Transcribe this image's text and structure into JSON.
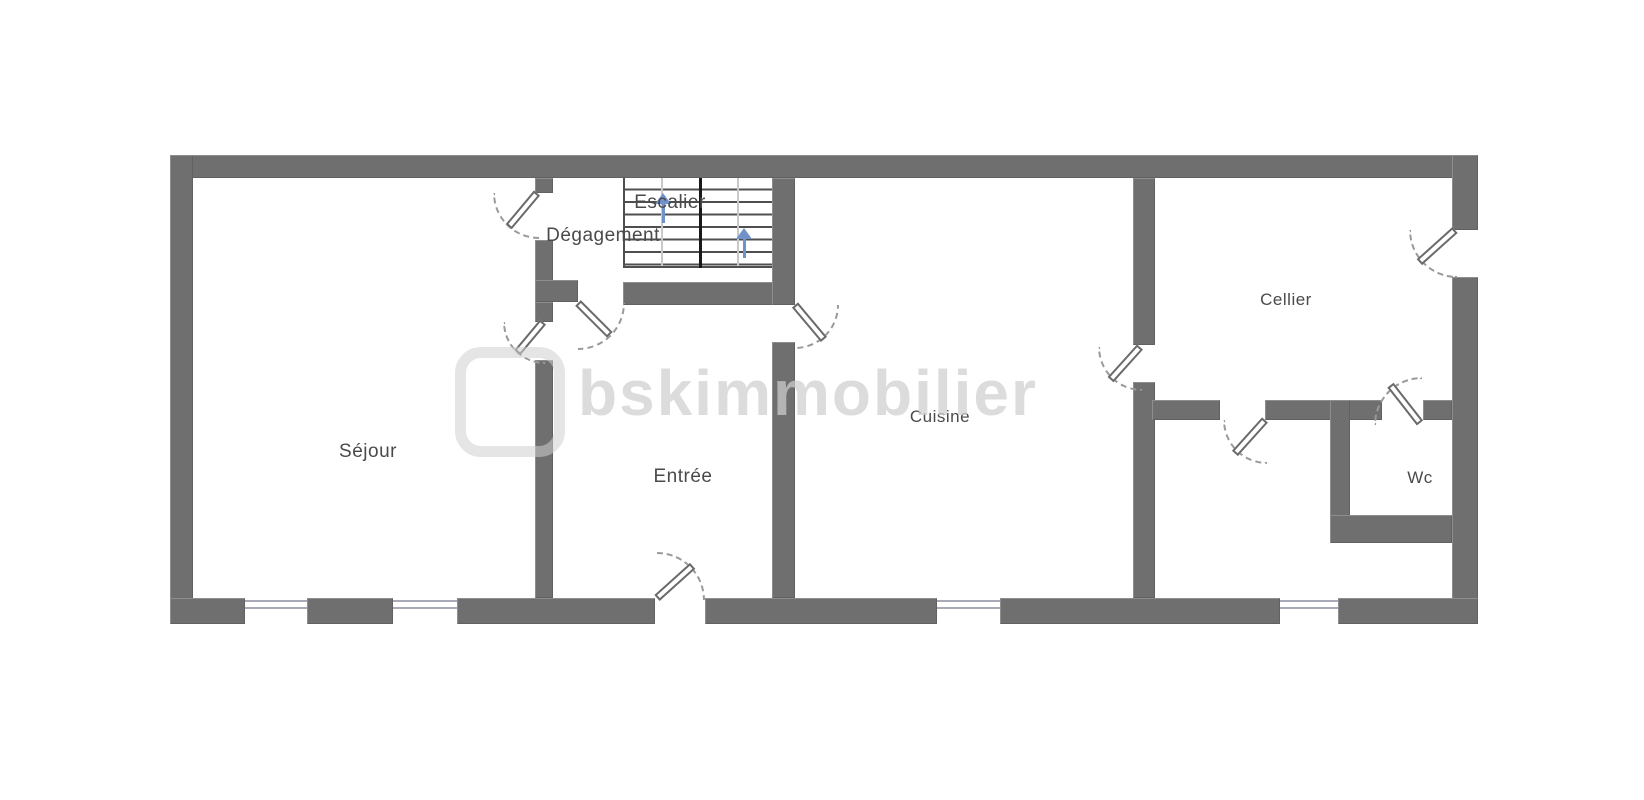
{
  "plan": {
    "rooms": [
      {
        "id": "sejour",
        "label": "Séjour"
      },
      {
        "id": "degagement",
        "label": "Dégagement"
      },
      {
        "id": "escalier",
        "label": "Escalier"
      },
      {
        "id": "entree",
        "label": "Entrée"
      },
      {
        "id": "cuisine",
        "label": "Cuisine"
      },
      {
        "id": "cellier",
        "label": "Cellier"
      },
      {
        "id": "wc",
        "label": "Wc"
      }
    ],
    "colors": {
      "wall": "#6f6f6f",
      "label": "#4a4a4a",
      "stair_arrow": "#7191c9",
      "window_line": "#a9aab8",
      "door_line": "#6a6a6a",
      "arc_line": "#9a9a9a",
      "stair_line": "#4f4f4f",
      "watermark": "#cfcfcf"
    }
  },
  "watermark": {
    "text": "bskimmobilier"
  }
}
